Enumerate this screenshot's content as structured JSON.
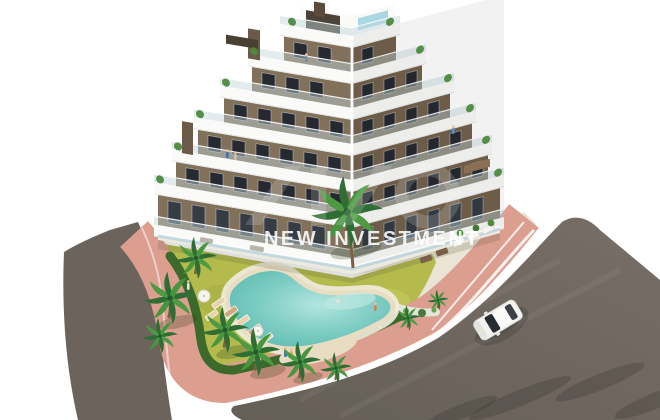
{
  "watermark": {
    "logo": "new-investment-monogram",
    "text": "NEW INVESTMENT"
  },
  "scene": {
    "type": "aerial-3d-architectural-render",
    "subject": "new-build apartment residence with terraces, communal pool garden, palm trees, surrounding streets and one white car",
    "palette": {
      "background": "#ffffff",
      "asphalt_road": "#6b635c",
      "pink_sidewalk": "#dc9e8f",
      "facade_brown": "#81705a",
      "balcony_white": "#fafaf8",
      "lawn_green": "#b4bb4c",
      "hedge_green": "#3c6a2b",
      "pool_turquoise": "#7ecdc4",
      "sand_beige": "#e8ddc3",
      "car_white": "#f2f2ef"
    }
  }
}
